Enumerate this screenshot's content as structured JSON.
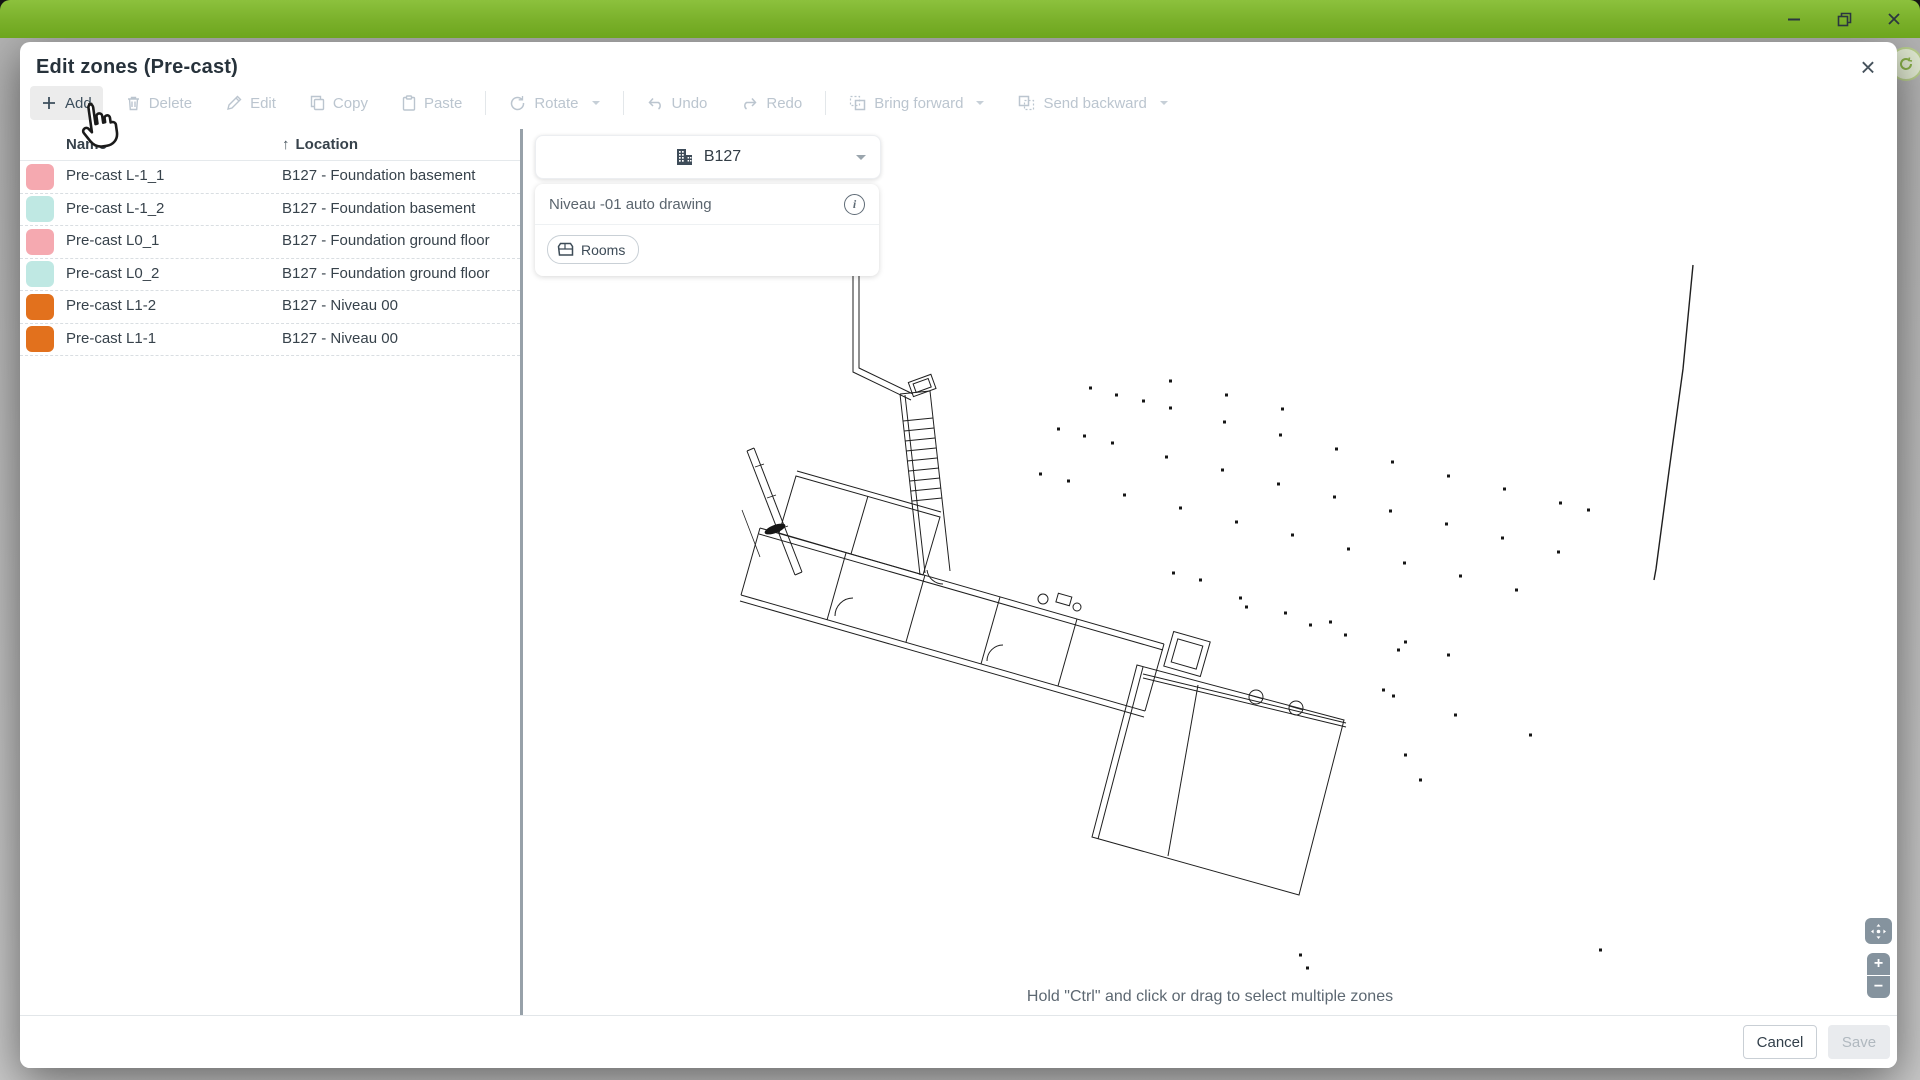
{
  "window": {
    "accent_green": "#7ab02a",
    "icons": {
      "minimize": "minimize-icon",
      "restore": "restore-icon",
      "close": "close-icon"
    }
  },
  "dialog": {
    "title": "Edit zones (Pre-cast)",
    "close_icon": "×",
    "toolbar": {
      "add": "Add",
      "delete": "Delete",
      "edit": "Edit",
      "copy": "Copy",
      "paste": "Paste",
      "rotate": "Rotate",
      "undo": "Undo",
      "redo": "Redo",
      "bring_forward": "Bring forward",
      "send_backward": "Send backward"
    },
    "table": {
      "columns": {
        "name": "Name",
        "location": "Location"
      },
      "sort_asc_icon": "↑",
      "rows": [
        {
          "color": "#f5a9b0",
          "pattern": "plain",
          "name": "Pre-cast L-1_1",
          "location": "B127 - Foundation basement"
        },
        {
          "color": "#bfe8e3",
          "pattern": "dots",
          "name": "Pre-cast L-1_2",
          "location": "B127 - Foundation basement"
        },
        {
          "color": "#f5a9b0",
          "pattern": "plain",
          "name": "Pre-cast L0_1",
          "location": "B127 - Foundation ground floor"
        },
        {
          "color": "#bfe8e3",
          "pattern": "dots",
          "name": "Pre-cast L0_2",
          "location": "B127 - Foundation ground floor"
        },
        {
          "color": "#e2711d",
          "pattern": "dots",
          "name": "Pre-cast L1-2",
          "location": "B127 - Niveau 00"
        },
        {
          "color": "#e2711d",
          "pattern": "dots",
          "name": "Pre-cast L1-1",
          "location": "B127 - Niveau 00"
        }
      ]
    },
    "map_panel": {
      "building_selector": {
        "value": "B127"
      },
      "drawing_card": {
        "title": "Niveau -01 auto drawing",
        "info_icon": "i",
        "chip_label": "Rooms"
      },
      "hint": "Hold \"Ctrl\" and click or drag to select multiple zones",
      "controls": {
        "zoom_in": "+",
        "zoom_out": "−"
      }
    },
    "footer": {
      "cancel": "Cancel",
      "save": "Save"
    }
  }
}
